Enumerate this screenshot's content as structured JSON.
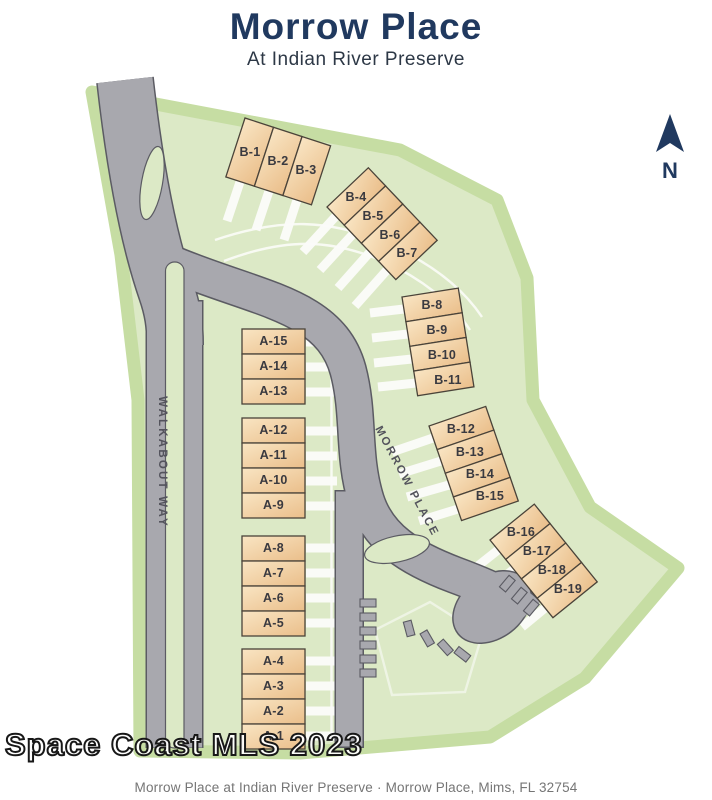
{
  "header": {
    "title": "Morrow Place",
    "subtitle": "At Indian River Preserve"
  },
  "map": {
    "north_label": "N",
    "roads": {
      "walkabout_way": "WALKABOUT WAY",
      "morrow_place": "MORROW PLACE"
    },
    "lots_a": [
      "A-1",
      "A-2",
      "A-3",
      "A-4",
      "A-5",
      "A-6",
      "A-7",
      "A-8",
      "A-9",
      "A-10",
      "A-11",
      "A-12",
      "A-13",
      "A-14",
      "A-15"
    ],
    "lots_b": [
      "B-1",
      "B-2",
      "B-3",
      "B-4",
      "B-5",
      "B-6",
      "B-7",
      "B-8",
      "B-9",
      "B-10",
      "B-11",
      "B-12",
      "B-13",
      "B-14",
      "B-15",
      "B-16",
      "B-17",
      "B-18",
      "B-19"
    ]
  },
  "watermark": "Space Coast MLS 2023",
  "footer": {
    "text": "Morrow Place at Indian River Preserve  ·  Morrow Place, Mims, FL 32754"
  },
  "colors": {
    "site_green": "#dce9c6",
    "boundary_band": "#c6dda3",
    "road_gray": "#a8a8ae",
    "road_edge": "#5b5b63",
    "lot_light": "#f9e5c3",
    "lot_dark": "#eabe8a",
    "lot_border": "#4a4339",
    "navy": "#20395f",
    "footer_gray": "#757575"
  }
}
